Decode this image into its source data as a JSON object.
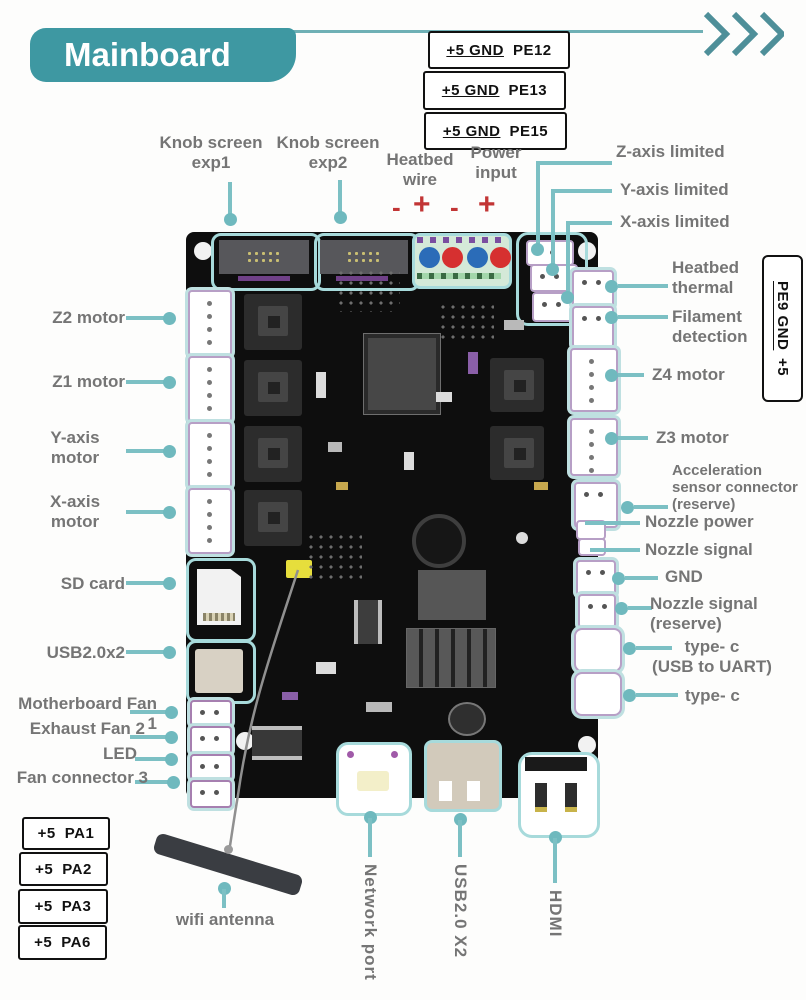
{
  "header": {
    "title": "Mainboard"
  },
  "pe_boxes": [
    {
      "power": "+5 GND",
      "pin": "PE12"
    },
    {
      "power": "+5 GND",
      "pin": "PE13"
    },
    {
      "power": "+5 GND",
      "pin": "PE15"
    }
  ],
  "side_box": {
    "power": "PE9 GND",
    "pin": "+5"
  },
  "pa_boxes": [
    {
      "power": "+5",
      "pin": "PA1"
    },
    {
      "power": "+5",
      "pin": "PA2"
    },
    {
      "power": "+5",
      "pin": "PA3"
    },
    {
      "power": "+5",
      "pin": "PA6"
    }
  ],
  "top_labels": {
    "knob1_line1": "Knob screen",
    "knob1_line2": "exp1",
    "knob2_line1": "Knob screen",
    "knob2_line2": "exp2",
    "heatbed_line1": "Heatbed",
    "heatbed_line2": "wire",
    "power_line1": "Power",
    "power_line2": "input",
    "polarity": [
      "-",
      "+",
      "-",
      "+"
    ]
  },
  "right_labels": {
    "z_limit": "Z-axis limited",
    "y_limit": "Y-axis limited",
    "x_limit": "X-axis limited",
    "heatbed_thermal_1": "Heatbed",
    "heatbed_thermal_2": "thermal",
    "filament_1": "Filament",
    "filament_2": "detection",
    "z4": "Z4 motor",
    "z3": "Z3 motor",
    "accel_1": "Acceleration",
    "accel_2": "sensor connector",
    "accel_3": "(reserve)",
    "nozzle_power": "Nozzle power",
    "nozzle_signal": "Nozzle signal",
    "gnd": "GND",
    "nozzle_reserve_1": "Nozzle signal",
    "nozzle_reserve_2": "(reserve)",
    "typec_uart_1": "type- c",
    "typec_uart_2": "(USB to UART)",
    "typec": "type- c"
  },
  "left_labels": {
    "z2": "Z2 motor",
    "z1": "Z1 motor",
    "y_1": "Y-axis",
    "y_2": "motor",
    "x_1": "X-axis",
    "x_2": "motor",
    "sd": "SD card",
    "usb": "USB2.0x2",
    "fan1": "Motherboard Fan 1",
    "fan2": "Exhaust Fan 2",
    "led": "LED",
    "fan3": "Fan connector 3"
  },
  "bottom_labels": {
    "wifi": "wifi antenna",
    "network": "Network port",
    "usb": "USB2.0 X2",
    "hdmi": "HDMI"
  },
  "colors": {
    "banner_teal": "#3e98a2",
    "line_teal": "#7cc0c4",
    "outline_teal": "#a7dadb",
    "label_gray": "#757575",
    "polarity_red": "#c23535",
    "board_black": "#0e0e0e"
  }
}
